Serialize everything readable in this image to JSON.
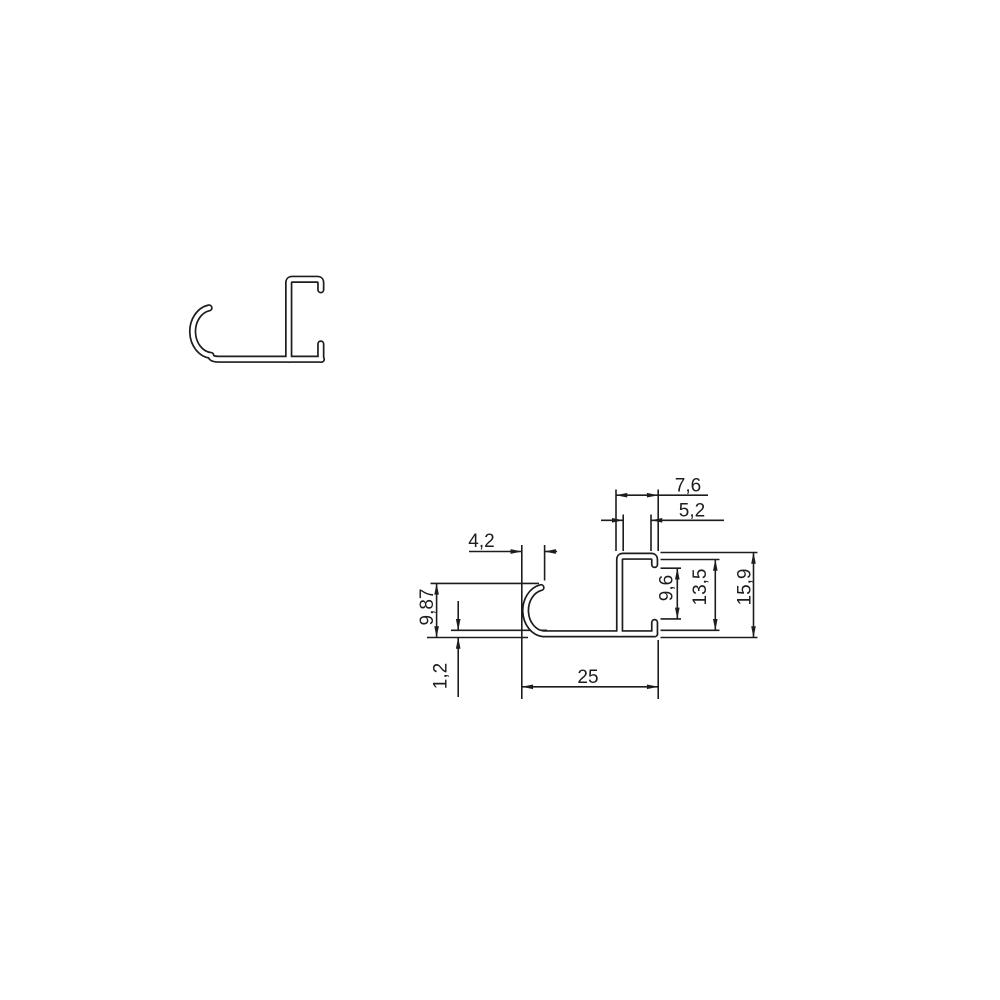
{
  "page": {
    "background_color": "#ffffff"
  },
  "drawing": {
    "kind": "aluminium profile cross-section technical drawing, two views",
    "line_color": "#1d1d1d",
    "views": {
      "clean": {
        "name": "profile outline view"
      },
      "dimensioned": {
        "name": "dimensioned cross-section view"
      }
    },
    "dimensions": {
      "tube_outer_width": {
        "value": "7,6"
      },
      "tube_inner_width": {
        "value": "5,2"
      },
      "hook_width": {
        "value": "4,2"
      },
      "hook_height": {
        "value": "9,87"
      },
      "base_thickness": {
        "value": "1,2"
      },
      "base_length": {
        "value": "25"
      },
      "slot_opening": {
        "value": "9,6"
      },
      "tube_inner_height": {
        "value": "13,5"
      },
      "tube_outer_height": {
        "value": "15,9"
      }
    }
  }
}
